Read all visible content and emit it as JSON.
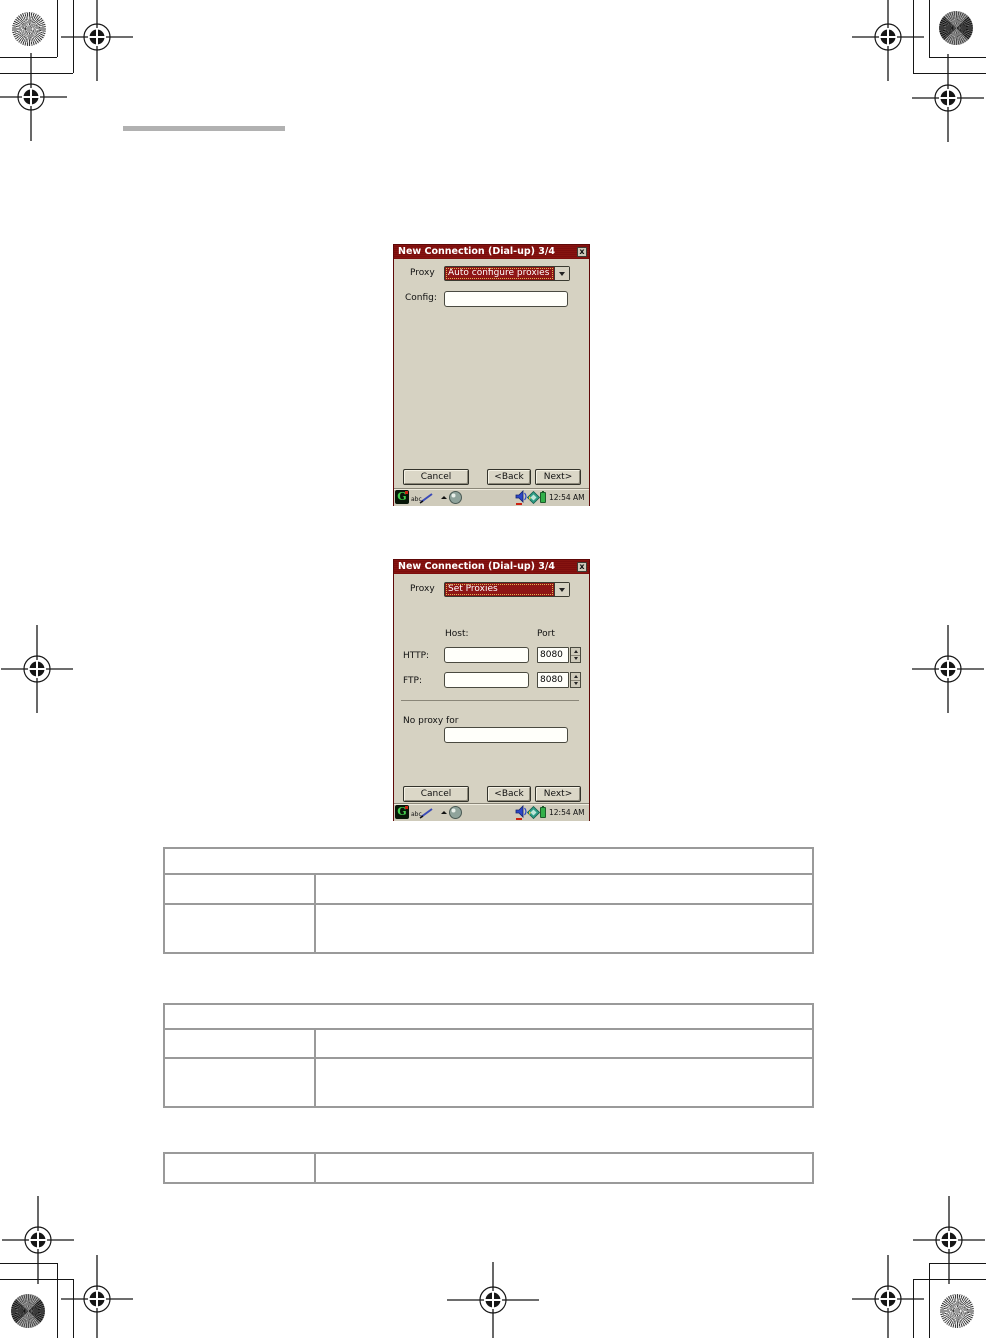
{
  "dialog1": {
    "title": "New Connection (Dial-up) 3/4",
    "close_glyph": "x",
    "proxy_label": "Proxy",
    "proxy_value": "Auto configure proxies",
    "config_label": "Config:",
    "config_value": "",
    "cancel_label": "Cancel",
    "back_label": "<Back",
    "next_label": "Next>"
  },
  "dialog2": {
    "title": "New Connection (Dial-up) 3/4",
    "close_glyph": "x",
    "proxy_label": "Proxy",
    "proxy_value": "Set Proxies",
    "host_label": "Host:",
    "port_label": "Port",
    "http_label": "HTTP:",
    "http_host_value": "",
    "http_port_value": "8080",
    "ftp_label": "FTP:",
    "ftp_host_value": "",
    "ftp_port_value": "8080",
    "no_proxy_label": "No proxy for",
    "no_proxy_value": "",
    "cancel_label": "Cancel",
    "back_label": "<Back",
    "next_label": "Next>"
  },
  "taskbar": {
    "launcher_glyph": "G",
    "input_method_label": "abc",
    "time": "12:54 AM",
    "icons": [
      "launcher-icon",
      "input-method-icon",
      "pencil-icon",
      "up-arrow-icon",
      "globe-icon",
      "speaker-icon",
      "card-icon",
      "battery-icon"
    ]
  },
  "tables": {
    "table1": {
      "header": "",
      "rows": [
        [
          "",
          ""
        ],
        [
          "",
          ""
        ]
      ]
    },
    "table2": {
      "header": "",
      "rows": [
        [
          "",
          ""
        ],
        [
          "",
          ""
        ]
      ]
    },
    "table3": {
      "rows": [
        [
          "",
          ""
        ]
      ]
    }
  },
  "colors": {
    "titlebar": "#7c0d0d",
    "selection": "#8e1515",
    "dialog_body": "#d6d2c2",
    "table_border": "#9a9a9a",
    "battery": "#33b04a"
  }
}
